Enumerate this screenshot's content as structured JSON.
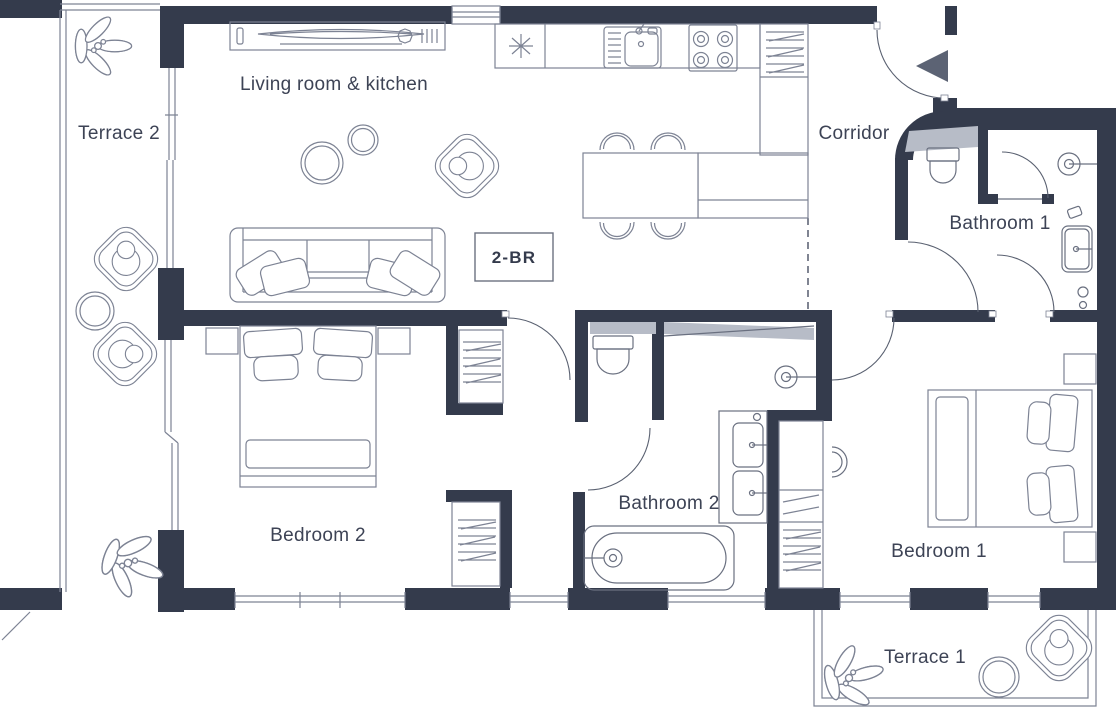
{
  "badge": {
    "label": "2-BR"
  },
  "rooms": {
    "terrace2": {
      "label": "Terrace 2"
    },
    "living": {
      "label": "Living room & kitchen"
    },
    "corridor": {
      "label": "Corridor"
    },
    "bathroom1": {
      "label": "Bathroom 1"
    },
    "bedroom2": {
      "label": "Bedroom 2"
    },
    "bathroom2": {
      "label": "Bathroom 2"
    },
    "bedroom1": {
      "label": "Bedroom 1"
    },
    "terrace1": {
      "label": "Terrace 1"
    }
  },
  "icons": {
    "entry_arrow": "entry-direction-triangle-left"
  },
  "colors": {
    "wall": "#343b4c",
    "furniture_line": "#7d8394",
    "fixture_line": "#6a7080",
    "glass_fill": "#b7bcc7",
    "label_text": "#3d4355",
    "entry_arrow": "#5c6374",
    "background": "#ffffff"
  }
}
